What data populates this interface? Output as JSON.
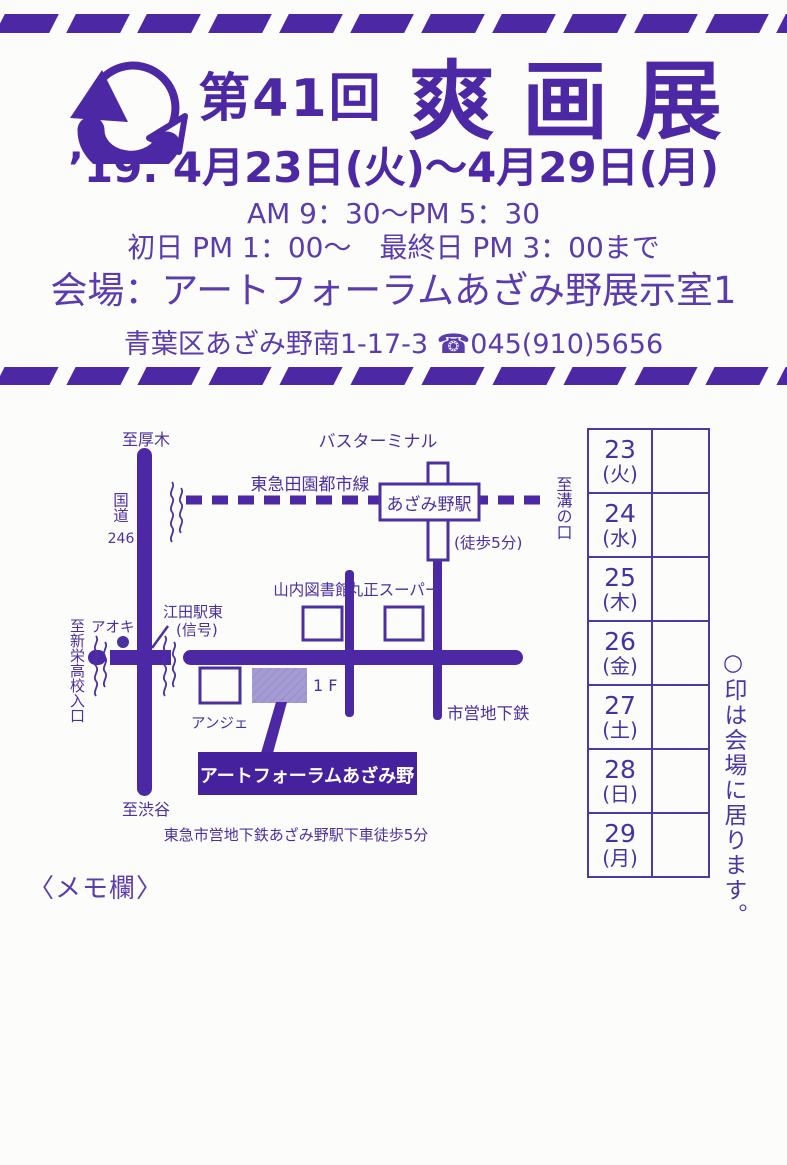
{
  "page": {
    "background": "#fcfcfb",
    "accent_color": "#4c28a4"
  },
  "header": {
    "title_prefix": "第41回",
    "title_main": "爽画展",
    "date_line": "’19. 4月23日(火)～4月29日(月)",
    "hours": "AM 9：30～PM 5：30",
    "hours_note": "初日 PM 1：00～　最終日 PM 3：00まで",
    "venue": "会場：アートフォーラムあざみ野展示室1",
    "address": "青葉区あざみ野南1-17-3 ☎045(910)5656"
  },
  "map": {
    "labels": {
      "to_atsugi": "至厚木",
      "bus_terminal": "バスターミナル",
      "rail_line": "東急田園都市線",
      "station": "あざみ野駅",
      "to_mizonokuchi": "至溝の口",
      "walk_5min": "(徒歩5分)",
      "route": "国道",
      "route_no": "246",
      "library": "山内図書館",
      "supermarket": "丸正スーパー",
      "eda_station_east": "江田駅東",
      "signal": "(信号)",
      "aoki": "アオキ",
      "to_shinei_school": "至新栄高校入口",
      "anje": "アンジェ",
      "floor": "1 F",
      "venue_box": "アートフォーラムあざみ野",
      "to_shibuya": "至渋谷",
      "subway": "市営地下鉄",
      "access_note": "東急市営地下鉄あざみ野駅下車徒歩5分"
    }
  },
  "calendar": {
    "rows": [
      {
        "day": "23",
        "wd": "(火)"
      },
      {
        "day": "24",
        "wd": "(水)"
      },
      {
        "day": "25",
        "wd": "(木)"
      },
      {
        "day": "26",
        "wd": "(金)"
      },
      {
        "day": "27",
        "wd": "(土)"
      },
      {
        "day": "28",
        "wd": "(日)"
      },
      {
        "day": "29",
        "wd": "(月)"
      }
    ],
    "note": "○印は会場に居ります。"
  },
  "memo_label": "〈メモ欄〉"
}
